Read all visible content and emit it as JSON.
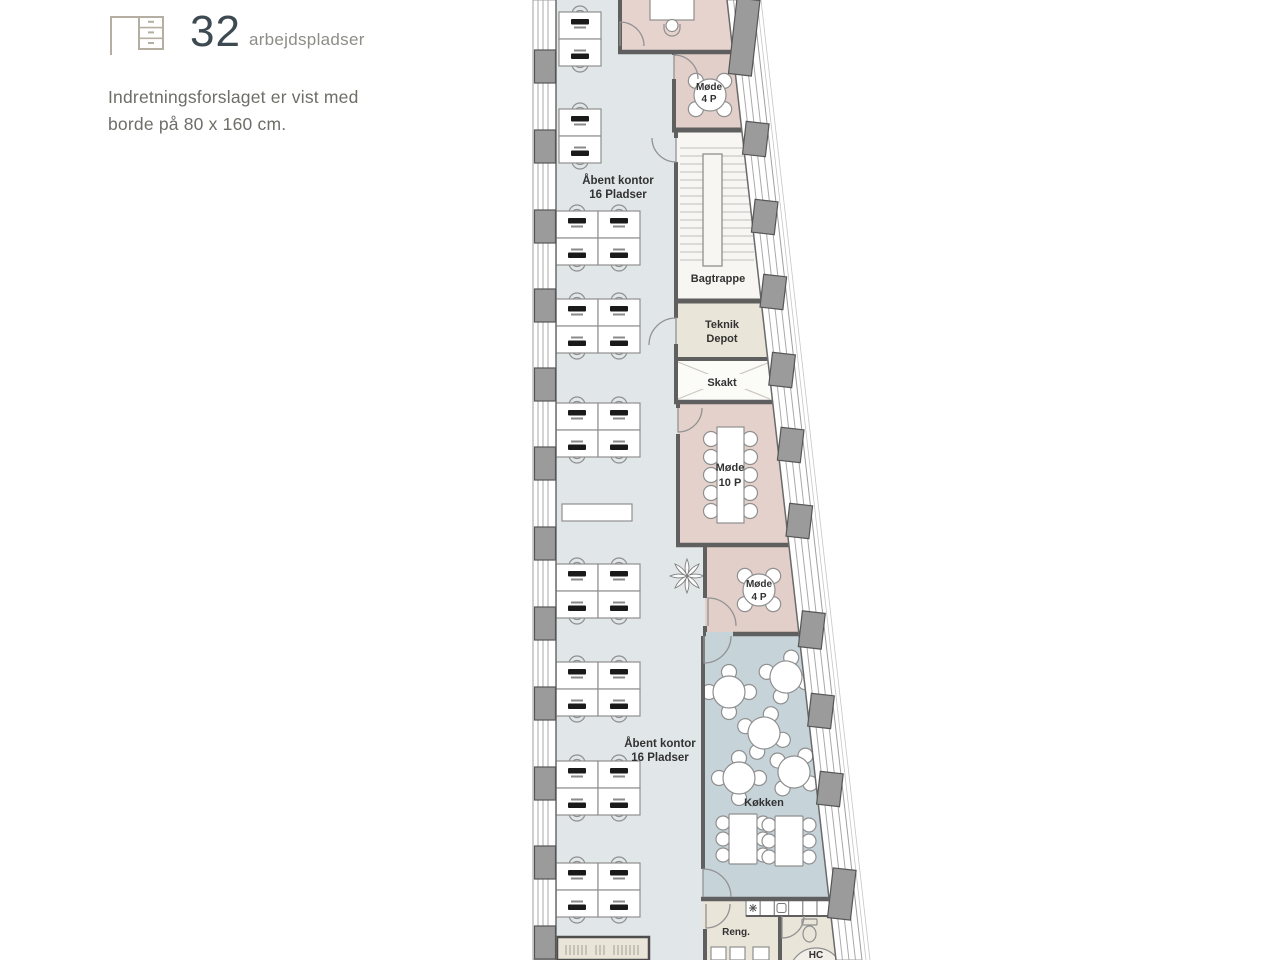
{
  "legend": {
    "workplaces_count": "32",
    "workplaces_label": "arbejdspladser",
    "note_line1": "Indretningsforslaget er vist med",
    "note_line2": "borde på 80 x 160 cm."
  },
  "plan": {
    "labels": {
      "open_top_1": "Åbent kontor",
      "open_top_2": "16 Pladser",
      "open_bottom_1": "Åbent kontor",
      "open_bottom_2": "16 Pladser",
      "mode4_top_1": "Møde",
      "mode4_top_2": "4 P",
      "bagtrappe": "Bagtrappe",
      "teknik_1": "Teknik",
      "teknik_2": "Depot",
      "skakt": "Skakt",
      "mode10_1": "Møde",
      "mode10_2": "10 P",
      "mode4_mid_1": "Møde",
      "mode4_mid_2": "4 P",
      "kokken": "Køkken",
      "reng": "Reng.",
      "hc": "HC"
    },
    "colors": {
      "open_office_floor": "#e1e6e9",
      "meeting_room": "#e3d0cb",
      "kitchen_floor": "#c6d4da",
      "service_room": "#eae5d9",
      "stair_room": "#f7f6f3",
      "wall": "#5f5f5f",
      "legend_accent": "#3e4a52",
      "legend_icon": "#b5afa3"
    }
  }
}
